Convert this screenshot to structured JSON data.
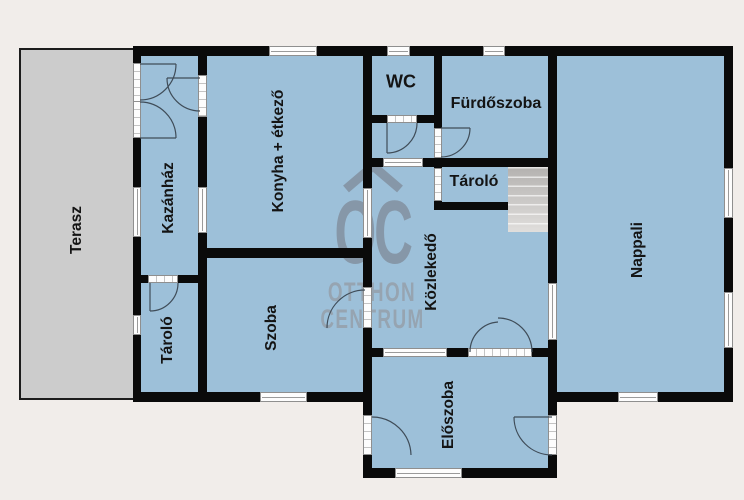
{
  "watermark": {
    "roof_icon": "house-roof-chevron",
    "logo": "OC",
    "line1": "OTTHON",
    "line2": "CENTRUM"
  },
  "rooms": {
    "terasz": "Terasz",
    "kazanhaz": "Kazánház",
    "konyha": "Konyha + étkező",
    "wc": "WC",
    "furdoszoba": "Fürdőszoba",
    "tarolo_felso": "Tároló",
    "tarolo_also": "Tároló",
    "szoba": "Szoba",
    "kozlekedo": "Közlekedő",
    "nappali": "Nappali",
    "eloszoba": "Előszoba"
  },
  "colors": {
    "background": "#f1edea",
    "room_fill": "#9dc0d9",
    "terrace_fill": "#cccccc",
    "wall": "#0a0a0a",
    "watermark_logo": "#8391a0",
    "watermark_text": "#95a0ab",
    "stairs": "#c9c7c5"
  }
}
